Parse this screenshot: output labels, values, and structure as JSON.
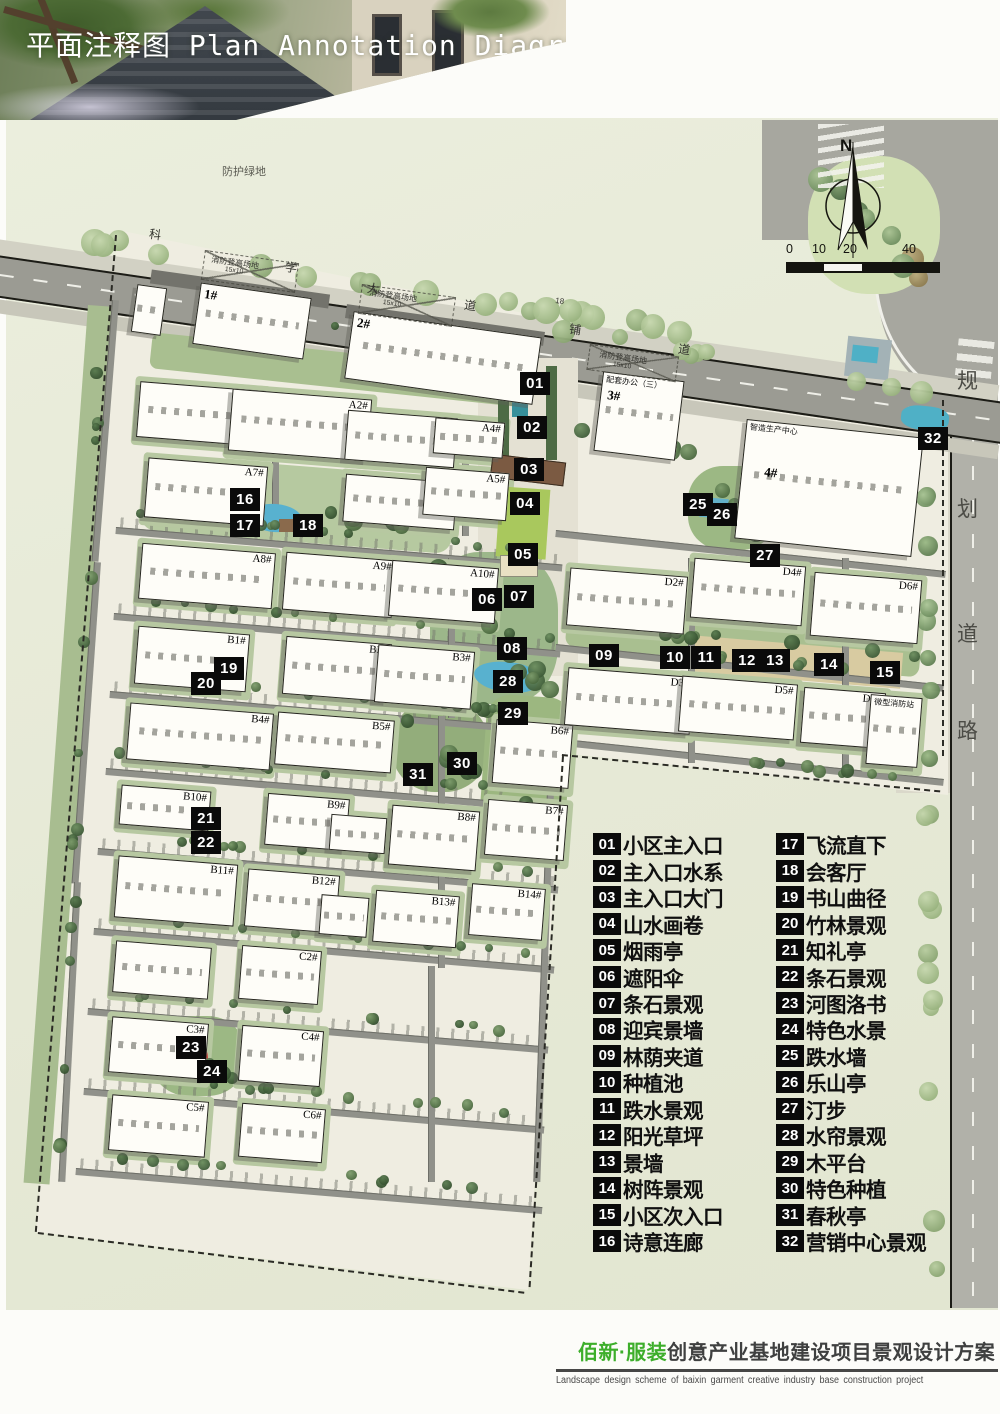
{
  "header": {
    "title": "平面注释图 Plan Annotation Diagram"
  },
  "compass": {
    "north_label": "N"
  },
  "scale_bar": {
    "ticks": [
      "0",
      "10",
      "20",
      "40"
    ]
  },
  "legend": {
    "column1": [
      {
        "no": "01",
        "label": "小区主入口"
      },
      {
        "no": "02",
        "label": "主入口水系"
      },
      {
        "no": "03",
        "label": "主入口大门"
      },
      {
        "no": "04",
        "label": "山水画卷"
      },
      {
        "no": "05",
        "label": "烟雨亭"
      },
      {
        "no": "06",
        "label": "遮阳伞"
      },
      {
        "no": "07",
        "label": "条石景观"
      },
      {
        "no": "08",
        "label": "迎宾景墙"
      },
      {
        "no": "09",
        "label": "林荫夹道"
      },
      {
        "no": "10",
        "label": "种植池"
      },
      {
        "no": "11",
        "label": "跌水景观"
      },
      {
        "no": "12",
        "label": "阳光草坪"
      },
      {
        "no": "13",
        "label": "景墙"
      },
      {
        "no": "14",
        "label": "树阵景观"
      },
      {
        "no": "15",
        "label": "小区次入口"
      },
      {
        "no": "16",
        "label": "诗意连廊"
      }
    ],
    "column2": [
      {
        "no": "17",
        "label": "飞流直下"
      },
      {
        "no": "18",
        "label": "会客厅"
      },
      {
        "no": "19",
        "label": "书山曲径"
      },
      {
        "no": "20",
        "label": "竹林景观"
      },
      {
        "no": "21",
        "label": "知礼亭"
      },
      {
        "no": "22",
        "label": "条石景观"
      },
      {
        "no": "23",
        "label": "河图洛书"
      },
      {
        "no": "24",
        "label": "特色水景"
      },
      {
        "no": "25",
        "label": "跌水墙"
      },
      {
        "no": "26",
        "label": "乐山亭"
      },
      {
        "no": "27",
        "label": "汀步"
      },
      {
        "no": "28",
        "label": "水帘景观"
      },
      {
        "no": "29",
        "label": "木平台"
      },
      {
        "no": "30",
        "label": "特色种植"
      },
      {
        "no": "31",
        "label": "春秋亭"
      },
      {
        "no": "32",
        "label": "营销中心景观"
      }
    ]
  },
  "map": {
    "buildings": [
      {
        "l": "1#",
        "x": 196,
        "y": 290,
        "w": 112,
        "h": 62,
        "r": 8,
        "ls": 13,
        "lx": 4,
        "ly": 2
      },
      {
        "l": "",
        "x": 134,
        "y": 286,
        "w": 30,
        "h": 48,
        "r": 8
      },
      {
        "l": "2#",
        "x": 348,
        "y": 324,
        "w": 190,
        "h": 68,
        "r": 8,
        "ls": 13,
        "lx": 4,
        "ly": 2
      },
      {
        "l": "3#",
        "x": 598,
        "y": 376,
        "w": 82,
        "h": 80,
        "r": 7,
        "ls": 13,
        "lx": 6,
        "ly": 14,
        "sub": "配套办公（三）"
      },
      {
        "l": "4#",
        "x": 740,
        "y": 428,
        "w": 178,
        "h": 120,
        "r": 6,
        "ls": 13,
        "lx": 22,
        "ly": 42,
        "sub": "智造生产中心"
      },
      {
        "l": "A1#",
        "x": 138,
        "y": 386,
        "w": 126,
        "h": 56,
        "r": 4.5
      },
      {
        "l": "A2#",
        "x": 230,
        "y": 394,
        "w": 140,
        "h": 62,
        "r": 4.5
      },
      {
        "l": "A3#",
        "x": 346,
        "y": 414,
        "w": 110,
        "h": 50,
        "r": 4.5
      },
      {
        "l": "A4#",
        "x": 434,
        "y": 420,
        "w": 70,
        "h": 36,
        "r": 4.5
      },
      {
        "l": "A7#",
        "x": 146,
        "y": 462,
        "w": 120,
        "h": 60,
        "r": 4.5
      },
      {
        "l": "A6#",
        "x": 344,
        "y": 478,
        "w": 112,
        "h": 48,
        "r": 4.5
      },
      {
        "l": "A5#",
        "x": 424,
        "y": 470,
        "w": 84,
        "h": 48,
        "r": 4.5
      },
      {
        "l": "A8#",
        "x": 140,
        "y": 548,
        "w": 134,
        "h": 56,
        "r": 4.5
      },
      {
        "l": "A9#",
        "x": 284,
        "y": 556,
        "w": 110,
        "h": 58,
        "r": 4.5
      },
      {
        "l": "A10#",
        "x": 390,
        "y": 564,
        "w": 107,
        "h": 56,
        "r": 4.5
      },
      {
        "l": "B1#",
        "x": 136,
        "y": 630,
        "w": 112,
        "h": 58,
        "r": 4.5
      },
      {
        "l": "B2#",
        "x": 284,
        "y": 640,
        "w": 106,
        "h": 58,
        "r": 4.5
      },
      {
        "l": "B3#",
        "x": 376,
        "y": 648,
        "w": 97,
        "h": 58,
        "r": 4.5
      },
      {
        "l": "B4#",
        "x": 128,
        "y": 708,
        "w": 144,
        "h": 57,
        "r": 4.5
      },
      {
        "l": "B5#",
        "x": 276,
        "y": 716,
        "w": 117,
        "h": 53,
        "r": 4.5
      },
      {
        "l": "B6#",
        "x": 494,
        "y": 722,
        "w": 77,
        "h": 64,
        "r": 4.5
      },
      {
        "l": "B10#",
        "x": 120,
        "y": 788,
        "w": 90,
        "h": 40,
        "r": 4.5
      },
      {
        "l": "B9#",
        "x": 266,
        "y": 796,
        "w": 82,
        "h": 52,
        "r": 4.5
      },
      {
        "l": "",
        "x": 330,
        "y": 816,
        "w": 56,
        "h": 36,
        "r": 4.5
      },
      {
        "l": "B8#",
        "x": 390,
        "y": 808,
        "w": 88,
        "h": 60,
        "r": 4.5
      },
      {
        "l": "B7#",
        "x": 486,
        "y": 802,
        "w": 80,
        "h": 56,
        "r": 4.5
      },
      {
        "l": "B11#",
        "x": 116,
        "y": 860,
        "w": 120,
        "h": 62,
        "r": 4.5
      },
      {
        "l": "B12#",
        "x": 246,
        "y": 872,
        "w": 92,
        "h": 58,
        "r": 4.5
      },
      {
        "l": "",
        "x": 320,
        "y": 896,
        "w": 48,
        "h": 40,
        "r": 4.5
      },
      {
        "l": "B13#",
        "x": 374,
        "y": 893,
        "w": 84,
        "h": 52,
        "r": 4.5
      },
      {
        "l": "B14#",
        "x": 470,
        "y": 886,
        "w": 74,
        "h": 52,
        "r": 4.5
      },
      {
        "l": "",
        "x": 114,
        "y": 944,
        "w": 96,
        "h": 52,
        "r": 4.5
      },
      {
        "l": "C2#",
        "x": 240,
        "y": 948,
        "w": 80,
        "h": 54,
        "r": 4.5
      },
      {
        "l": "C3#",
        "x": 110,
        "y": 1020,
        "w": 97,
        "h": 56,
        "r": 4.5
      },
      {
        "l": "C4#",
        "x": 240,
        "y": 1028,
        "w": 82,
        "h": 56,
        "r": 4.5
      },
      {
        "l": "C5#",
        "x": 110,
        "y": 1098,
        "w": 97,
        "h": 56,
        "r": 4.5
      },
      {
        "l": "C6#",
        "x": 240,
        "y": 1106,
        "w": 84,
        "h": 54,
        "r": 4.5
      },
      {
        "l": "D2#",
        "x": 568,
        "y": 572,
        "w": 118,
        "h": 58,
        "r": 4.5
      },
      {
        "l": "D4#",
        "x": 692,
        "y": 562,
        "w": 112,
        "h": 60,
        "r": 4.5
      },
      {
        "l": "D6#",
        "x": 812,
        "y": 576,
        "w": 108,
        "h": 64,
        "r": 4.5
      },
      {
        "l": "D3#",
        "x": 566,
        "y": 672,
        "w": 126,
        "h": 58,
        "r": 4.5
      },
      {
        "l": "D5#",
        "x": 680,
        "y": 680,
        "w": 116,
        "h": 56,
        "r": 4.5
      },
      {
        "l": "D7#",
        "x": 802,
        "y": 690,
        "w": 82,
        "h": 56,
        "r": 4.5
      },
      {
        "l": "",
        "x": 868,
        "y": 696,
        "w": 52,
        "h": 70,
        "r": 4.5,
        "sub": "微型消防站"
      }
    ],
    "markers": [
      {
        "n": "01",
        "x": 535,
        "y": 384
      },
      {
        "n": "02",
        "x": 532,
        "y": 428
      },
      {
        "n": "03",
        "x": 529,
        "y": 470
      },
      {
        "n": "04",
        "x": 525,
        "y": 504
      },
      {
        "n": "05",
        "x": 523,
        "y": 555
      },
      {
        "n": "06",
        "x": 487,
        "y": 600
      },
      {
        "n": "07",
        "x": 519,
        "y": 597
      },
      {
        "n": "08",
        "x": 512,
        "y": 649
      },
      {
        "n": "09",
        "x": 604,
        "y": 656
      },
      {
        "n": "10",
        "x": 675,
        "y": 658
      },
      {
        "n": "11",
        "x": 706,
        "y": 658
      },
      {
        "n": "12",
        "x": 747,
        "y": 661
      },
      {
        "n": "13",
        "x": 775,
        "y": 661
      },
      {
        "n": "14",
        "x": 829,
        "y": 665
      },
      {
        "n": "15",
        "x": 885,
        "y": 673
      },
      {
        "n": "16",
        "x": 245,
        "y": 500
      },
      {
        "n": "17",
        "x": 245,
        "y": 526
      },
      {
        "n": "18",
        "x": 308,
        "y": 526
      },
      {
        "n": "19",
        "x": 229,
        "y": 669
      },
      {
        "n": "20",
        "x": 206,
        "y": 684
      },
      {
        "n": "21",
        "x": 206,
        "y": 819
      },
      {
        "n": "22",
        "x": 206,
        "y": 843
      },
      {
        "n": "23",
        "x": 191,
        "y": 1048
      },
      {
        "n": "24",
        "x": 212,
        "y": 1072
      },
      {
        "n": "25",
        "x": 698,
        "y": 505
      },
      {
        "n": "26",
        "x": 722,
        "y": 515
      },
      {
        "n": "27",
        "x": 765,
        "y": 556
      },
      {
        "n": "28",
        "x": 508,
        "y": 682
      },
      {
        "n": "29",
        "x": 513,
        "y": 714
      },
      {
        "n": "30",
        "x": 462,
        "y": 764
      },
      {
        "n": "31",
        "x": 418,
        "y": 775
      },
      {
        "n": "32",
        "x": 933,
        "y": 439
      }
    ],
    "area_labels": [
      {
        "t": "防护绿地",
        "x": 222,
        "y": 166,
        "s": 11,
        "c": "#5a5a52"
      },
      {
        "t": "科",
        "x": 150,
        "y": 228,
        "s": 12,
        "r": 8
      },
      {
        "t": "学",
        "x": 286,
        "y": 261,
        "s": 12,
        "r": 8
      },
      {
        "t": "大",
        "x": 368,
        "y": 282,
        "s": 12,
        "r": 8
      },
      {
        "t": "道",
        "x": 465,
        "y": 299,
        "s": 12,
        "r": 8
      },
      {
        "t": "18",
        "x": 556,
        "y": 296,
        "s": 8,
        "r": 8
      },
      {
        "t": "铺",
        "x": 570,
        "y": 323,
        "s": 12,
        "r": 8
      },
      {
        "t": "道",
        "x": 679,
        "y": 343,
        "s": 12,
        "r": 8
      },
      {
        "t": "消防登高场地",
        "sub": "15x10",
        "x": 212,
        "y": 255,
        "s": 8,
        "r": 8
      },
      {
        "t": "消防登高场地",
        "sub": "15x10",
        "x": 370,
        "y": 288,
        "s": 8,
        "r": 8
      },
      {
        "t": "消防登高场地",
        "sub": "15x10",
        "x": 600,
        "y": 350,
        "s": 8,
        "r": 8
      },
      {
        "t": "规",
        "x": 957,
        "y": 370,
        "s": 21,
        "c": "#4c4c46"
      },
      {
        "t": "划",
        "x": 957,
        "y": 498,
        "s": 21,
        "c": "#4c4c46"
      },
      {
        "t": "道",
        "x": 957,
        "y": 623,
        "s": 21,
        "c": "#4c4c46"
      },
      {
        "t": "路",
        "x": 957,
        "y": 720,
        "s": 21,
        "c": "#4c4c46"
      }
    ]
  },
  "footer": {
    "brand": "佰新·服装",
    "title": "创意产业基地建设项目景观设计方案",
    "subtitle": "Landscape design scheme of baixin garment creative industry base construction project"
  },
  "colors": {
    "accent_green": "#3dae2b",
    "title_gray": "#3f4040",
    "marker_black": "#0a0a0a",
    "water_blue": "#58b1cf",
    "lawn_green": "#a9c85d",
    "gate_brown": "#7b5a42",
    "road_gray": "#90918a",
    "site_beige": "#efede1",
    "surround_green": "#e9ecda"
  }
}
